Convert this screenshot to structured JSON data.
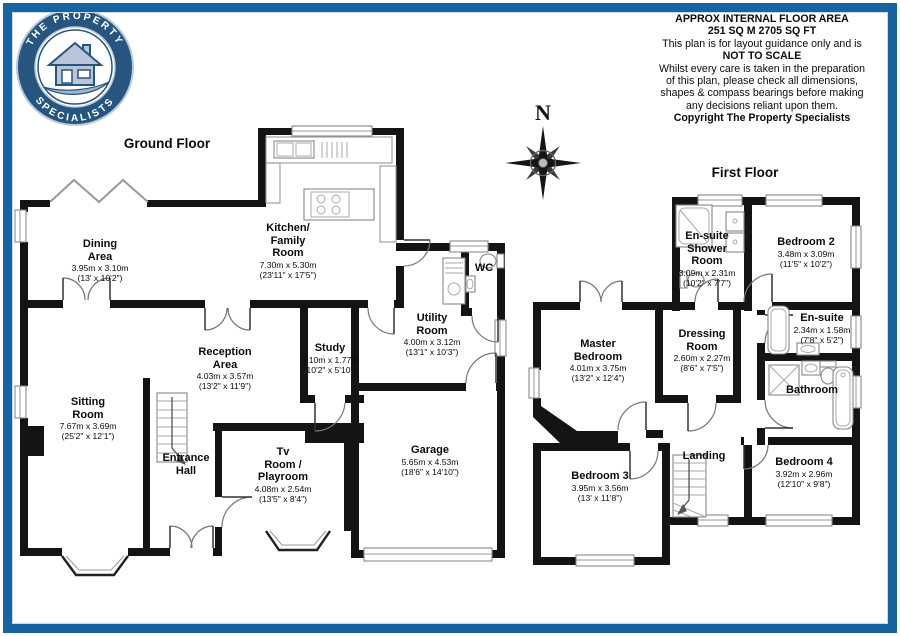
{
  "logo": {
    "name": "The Property Specialists logo",
    "arc_top": "THE PROPERTY",
    "arc_bottom": "SPECIALISTS",
    "navy": "#26567f",
    "house_fill": "#b9c6da"
  },
  "disclaimer": {
    "lines": [
      "APPROX INTERNAL FLOOR AREA",
      "251 SQ M 2705 SQ FT",
      "This plan is for layout guidance only and is",
      "NOT TO SCALE",
      "Whilst every care is taken in the preparation",
      "of this plan, please check all dimensions,",
      "shapes & compass bearings before making",
      "any decisions reliant upon them.",
      "Copyright The Property Specialists"
    ]
  },
  "compass": {
    "north_label": "N"
  },
  "page": {
    "border_color": "#1563a0",
    "wall_color": "#141414"
  },
  "floors": {
    "ground": {
      "title": "Ground Floor",
      "rooms": [
        {
          "name": "Dining\nArea",
          "dims_m": "3.95m x 3.10m",
          "dims_ft": "(13' x 10'2\")"
        },
        {
          "name": "Kitchen/\nFamily\nRoom",
          "dims_m": "7.30m x 5.30m",
          "dims_ft": "(23'11\" x 17'5\")"
        },
        {
          "name": "WC"
        },
        {
          "name": "Utility\nRoom",
          "dims_m": "4.00m x 3.12m",
          "dims_ft": "(13'1\" x 10'3\")"
        },
        {
          "name": "Reception\nArea",
          "dims_m": "4.03m x 3.57m",
          "dims_ft": "(13'2\" x 11'9\")"
        },
        {
          "name": "Study",
          "dims_m": "3.10m x 1.77m",
          "dims_ft": "(10'2\" x 5'10\")"
        },
        {
          "name": "Sitting\nRoom",
          "dims_m": "7.67m x 3.69m",
          "dims_ft": "(25'2\" x 12'1\")"
        },
        {
          "name": "Entrance\nHall"
        },
        {
          "name": "Tv\nRoom /\nPlayroom",
          "dims_m": "4.08m x 2.54m",
          "dims_ft": "(13'5\" x 8'4\")"
        },
        {
          "name": "Garage",
          "dims_m": "5.65m x 4.53m",
          "dims_ft": "(18'6\" x 14'10\")"
        }
      ]
    },
    "first": {
      "title": "First Floor",
      "rooms": [
        {
          "name": "En-suite\nShower\nRoom",
          "dims_m": "3.09m x 2.31m",
          "dims_ft": "(10'2\" x 7'7\")"
        },
        {
          "name": "Bedroom 2",
          "dims_m": "3.48m x 3.09m",
          "dims_ft": "(11'5\" x 10'2\")"
        },
        {
          "name": "Master\nBedroom",
          "dims_m": "4.01m x 3.75m",
          "dims_ft": "(13'2\" x 12'4\")"
        },
        {
          "name": "Dressing\nRoom",
          "dims_m": "2.60m x 2.27m",
          "dims_ft": "(8'6\" x 7'5\")"
        },
        {
          "name": "En-suite",
          "dims_m": "2.34m x 1.58m",
          "dims_ft": "(7'8\" x 5'2\")"
        },
        {
          "name": "Bathroom"
        },
        {
          "name": "Bedroom 3",
          "dims_m": "3.95m x 3.56m",
          "dims_ft": "(13' x 11'8\")"
        },
        {
          "name": "Landing"
        },
        {
          "name": "Bedroom 4",
          "dims_m": "3.92m x 2.96m",
          "dims_ft": "(12'10\" x 9'8\")"
        }
      ]
    }
  }
}
